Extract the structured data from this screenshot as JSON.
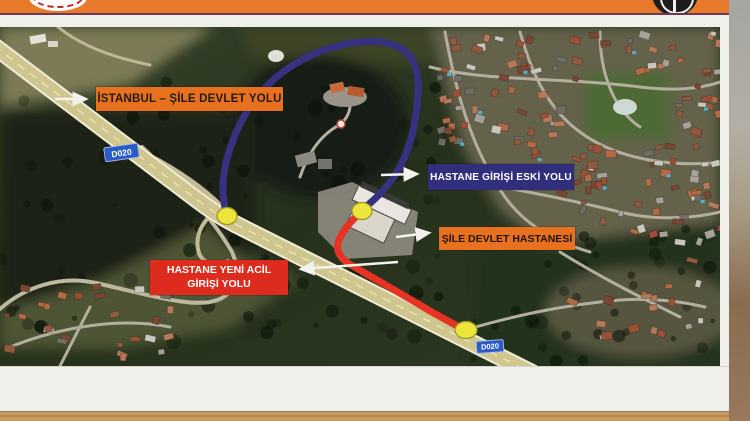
{
  "board": {
    "type": "roadside-information-sign",
    "header": {
      "left_logo": "general-directorate-of-highways-emblem",
      "right_logo": "municipality-emblem"
    }
  },
  "map": {
    "kind": "satellite-annotated-route-map",
    "labels": {
      "highway": {
        "text": "İSTANBUL – ŞİLE DEVLET YOLU",
        "bg": "#E8711F",
        "fg": "#211A12"
      },
      "old_entrance": {
        "text": "HASTANE GİRİŞİ ESKİ  YOLU",
        "bg": "#312E7C",
        "fg": "#FFFFFF"
      },
      "hospital": {
        "text": "ŞİLE DEVLET HASTANESİ",
        "bg": "#E8711F",
        "fg": "#20150D"
      },
      "new_emergency": {
        "line1": "HASTANE YENİ ACİL",
        "line2": "GİRİŞİ YOLU",
        "bg": "#DD2B1E",
        "fg": "#FFFFFF"
      }
    },
    "road_badge": "D020",
    "routes": {
      "old_entrance_route_color": "#37327F",
      "new_emergency_route_color": "#E63323"
    },
    "junction_marker_color": "#EDE43C",
    "junction_marker_count": 3
  },
  "colors": {
    "header-orange": "#E8782A",
    "label-orange": "#E8711F",
    "label-navy": "#312E7C",
    "label-red": "#DD2B1E",
    "route-old": "#37327F",
    "route-new": "#E63323",
    "junction-yellow": "#EDE43C",
    "badge-blue": "#2A5BC7",
    "board-white": "#F0F0EA",
    "wood": "#C99C63"
  }
}
